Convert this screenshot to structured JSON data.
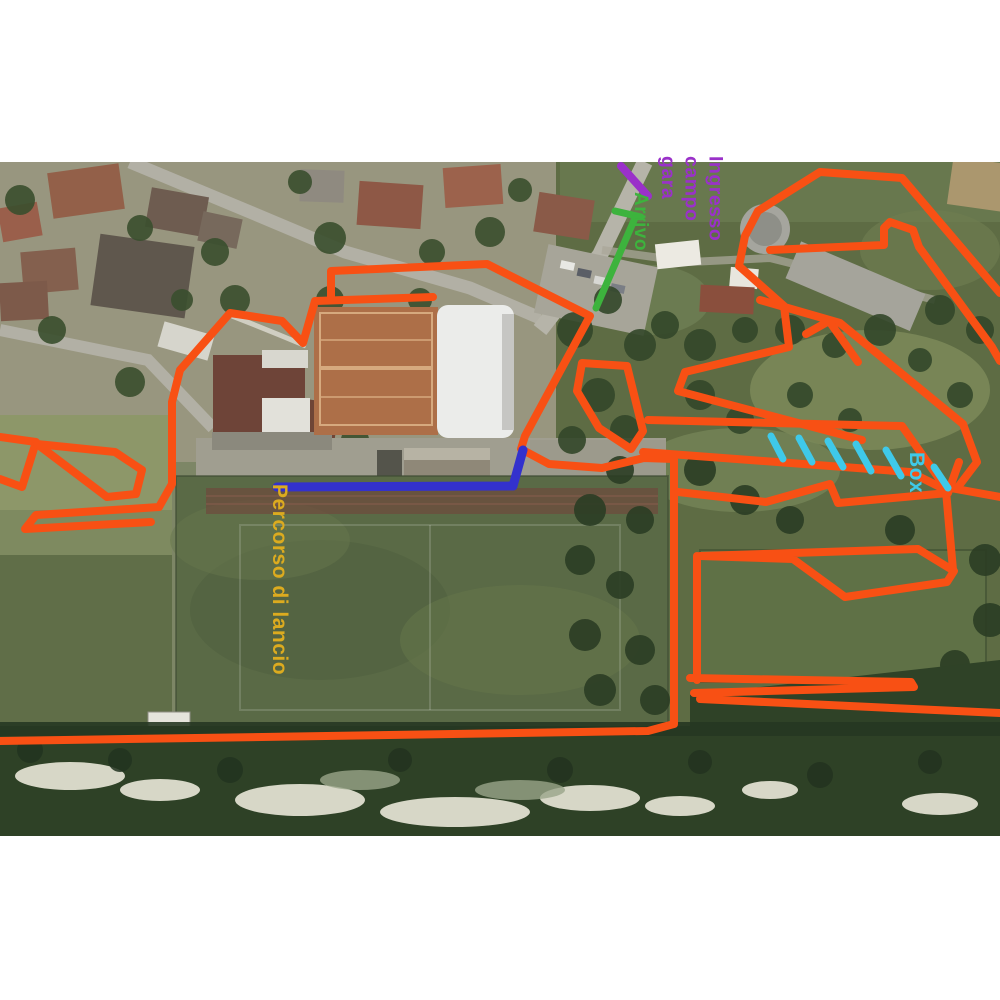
{
  "map": {
    "labels": {
      "entrance_lines": [
        "Ingresso",
        "campo",
        "gara"
      ],
      "finish": "Arrivo",
      "launch_path": "Percorso di lancio",
      "box": "Box"
    },
    "colors": {
      "course_route": "#f85014",
      "launch_route": "#3331cd",
      "finish_marker": "#3db33d",
      "entrance_marker": "#9a31c9",
      "box_marks": "#3fc9e9",
      "launch_label_text": "#dcab1f"
    }
  }
}
